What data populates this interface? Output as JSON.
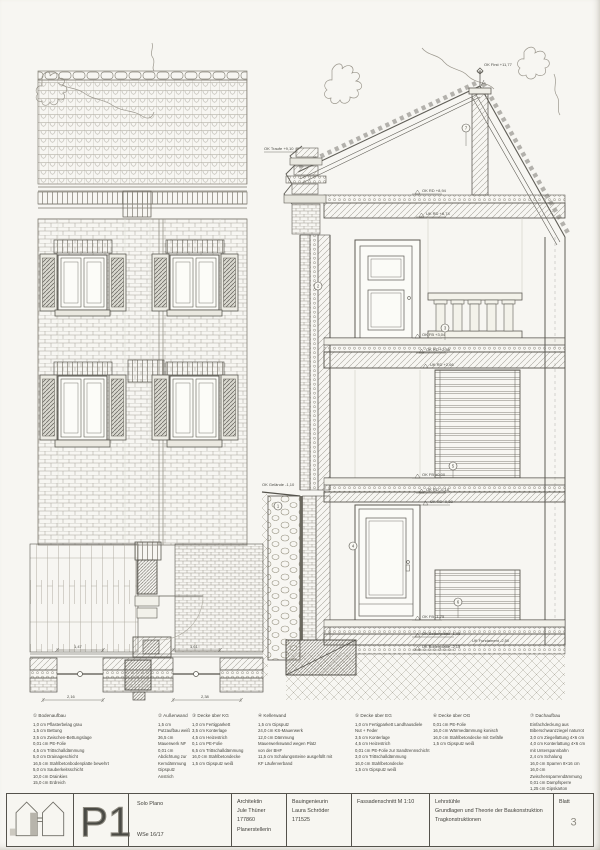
{
  "titleblock": {
    "project_code": "P1",
    "plan": {
      "l1": "Solo Plano",
      "l2": "WSe 16/17"
    },
    "architect": [
      "Architektin",
      "Jule Thüner 177860",
      "Planerstellerin"
    ],
    "engineer": [
      "Bauingenieurin",
      "Laura Schröder 171525"
    ],
    "drawing_title": "Fassadenschnitt   M 1:10",
    "chairs": [
      "Lehrstühle",
      "Grundlagen und Theorie der Baukonstruktion",
      "Tragkonstruktionen"
    ],
    "sheet_label": "Blatt",
    "sheet_number": "3"
  },
  "legend": {
    "columns": [
      {
        "num": "①",
        "title": "Bodenaufbau",
        "rows": [
          "1,0 cm  Pflasterbelag grau",
          "1,5 cm  Bettung",
          "3,5 cm  Zwischen-Bettungslage",
          "0,01 cm  PE-Folie",
          "4,5 cm  Trittschalldämmung",
          "5,0 cm  Drainageschicht",
          "16,5 cm  Stahlbetonbodenplatte bewehrt",
          "5,0 cm  Sauberkeitsschicht",
          "10,0 cm  Drainkies",
          "15,0 cm  Erdreich"
        ]
      },
      {
        "num": "②",
        "title": "Außenwand",
        "rows": [
          "1,5 cm  Putzaufbau weiß",
          "36,5 cm  Mauerwerk NF",
          "0,01 cm  Abdichtung zur Kerndämmung",
          "Gipsputz",
          "Anstrich"
        ]
      },
      {
        "num": "③",
        "title": "Decke über KG",
        "rows": [
          "1,0 cm  Fertigparkett",
          "3,5 cm  Konterlage",
          "4,5 cm  Heizestrich",
          "0,1 cm  PE-Folie",
          "6,5 cm  Trittschalldämmung",
          "16,0 cm  Stahlbetondecke",
          "1,5 cm  Gipsputz weiß"
        ]
      },
      {
        "num": "④",
        "title": "Kellerwand",
        "rows": [
          "1,5 cm  Gipsputz",
          "24,0 cm  KS-Mauerwerk",
          "12,0 cm  Dämmung",
          "Mauerwerkswand wegen Platz",
          "von der BHF",
          "11,5 cm  Schalungssteine ausgefüllt mit",
          "KF Läuferverband"
        ]
      },
      {
        "num": "⑤",
        "title": "Decke über EG",
        "rows": [
          "1,0 cm  Fertigparkett Landhausdiele",
          "Nut + Feder",
          "3,5 cm  Konterlage",
          "4,5 cm  Heizestrich",
          "0,01 cm  PE-Folie zur Sandtrennschicht",
          "3,0 cm  Trittschalldämmung",
          "16,0 cm  Stahlbetondecke",
          "1,5 cm  Gipsputz weiß"
        ]
      },
      {
        "num": "⑥",
        "title": "Decke über OG",
        "rows": [
          "0,01 cm  PE-Folie",
          "16,0 cm  Wärmedämmung konisch",
          "16,0 cm  Stahlbetondecke mit Gefälle",
          "1,5 cm  Gipsputz weiß"
        ]
      },
      {
        "num": "⑦",
        "title": "Dachaufbau",
        "rows": [
          "Einfachdeckung aus",
          "Biberschwanzziegel naturrot",
          "3,0 cm  Ziegellattung 4×6 cm",
          "4,0 cm  Konterlattung 4×6 cm",
          "mit Unterspannbahn",
          "2,4 cm  Schalung",
          "16,0 cm  Sparren 8×16 cm",
          "16,0 cm  Zwischensparrendämmung",
          "0,01 cm  Dampfsperre",
          "1,25 cm  Gipskarton",
          "3,0 cm  Lattung 3×5 cm, Anstrich weiß"
        ]
      }
    ]
  },
  "section": {
    "levels": [
      {
        "label": "OK First +11,77"
      },
      {
        "label": "OK Traufe +9,10"
      },
      {
        "label": "OK RD +8,94"
      },
      {
        "label": "UK RD +8,74"
      },
      {
        "label": "OK FB +3,04"
      },
      {
        "label": "OK RD +2,86"
      },
      {
        "label": "UK RD +2,66"
      },
      {
        "label": "OK FB ±0,00"
      },
      {
        "label": "OK RD -0,18"
      },
      {
        "label": "UK RD -0,38"
      },
      {
        "label": "OK FB -1,75"
      },
      {
        "label": "OK Bodenplatte -1,95"
      },
      {
        "label": "UK Bodenplatte -2,15"
      },
      {
        "label": "UK Fundament -2,50"
      },
      {
        "label": "OK Gelände -1,10"
      }
    ],
    "markers": [
      {
        "n": "7"
      },
      {
        "n": "2"
      },
      {
        "n": "3"
      },
      {
        "n": "5"
      },
      {
        "n": "4"
      },
      {
        "n": "6"
      },
      {
        "n": "1"
      }
    ]
  },
  "detail": {
    "dims": {
      "d1": "1,47",
      "d2": "1,61",
      "d3": "2,16",
      "d4": "2,38"
    }
  }
}
